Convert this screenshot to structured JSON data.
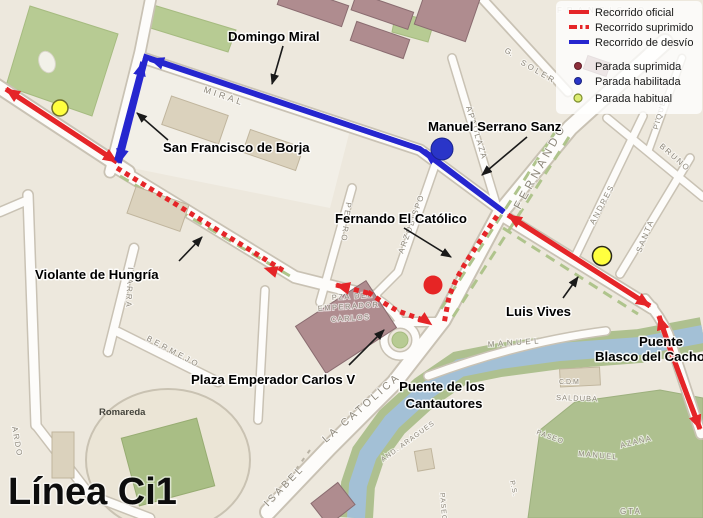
{
  "title": "Línea Ci1",
  "legend": {
    "recorrido_oficial": "Recorrido oficial",
    "recorrido_suprimido": "Recorrido suprimido",
    "recorrido_desvio": "Recorrido de desvío",
    "parada_suprimida": "Parada suprimida",
    "parada_habilitada": "Parada habilitada",
    "parada_habitual": "Parada habitual"
  },
  "callouts": {
    "domingo_miral": "Domingo Miral",
    "san_francisco_de_borja": "San Francisco de Borja",
    "manuel_serrano_sanz": "Manuel Serrano Sanz",
    "fernando_el_catolico": "Fernando El Católico",
    "violante_de_hungria": "Violante de Hungría",
    "luis_vives": "Luis Vives",
    "plaza_emperador_carlos": "Plaza Emperador Carlos V",
    "puente_cantautores_line1": "Puente de los",
    "puente_cantautores_line2": "Cantautores",
    "puente_cacho_line1": "Puente",
    "puente_cacho_line2": "Blasco del Cacho"
  },
  "streets": {
    "miral": "MIRAL",
    "g": "G.",
    "soler": "SOLER",
    "apaolaza": "APAOLAZA",
    "fernando": "FERNANDO",
    "pedro": "PEDRO",
    "arzobispo": "ARZOBISPO",
    "andres": "ANDRES",
    "santa": "SANTA",
    "bruno": "BRUNO",
    "piquer": "PIQUER",
    "ibarra": "IBARRA",
    "bermejo": "BERMEJO",
    "isabel": "ISABEL",
    "la_catolica": "LA CATOLICA",
    "manuel": "MANUEL",
    "and_aragues": "AND. ARAGUES",
    "paseo": "PASEO",
    "manuel_azana": "MANUEL",
    "azana": "AZAÑA",
    "cdm": "C.D.M",
    "salduba": "SALDUBA",
    "gta": "GTA",
    "ps": "P.S.",
    "paseo_sur": "PASEO",
    "ardo": "ARDO",
    "francisco": "FRANCISCO",
    "plaza_line1": "PZA DEL",
    "plaza_line2": "EMPERADOR",
    "plaza_line3": "CARLOS",
    "romareda": "Romareda"
  },
  "routes": {
    "oficial": {
      "style": "solid",
      "color": "#E52528"
    },
    "suprimido": {
      "style": "dashed",
      "color": "#E52528"
    },
    "desvio": {
      "style": "solid",
      "color": "#2626CF"
    }
  },
  "stops": [
    {
      "type": "Parada habitual",
      "color": "#FFFF3F"
    },
    {
      "type": "Parada habitual",
      "color": "#FFFF3F"
    },
    {
      "type": "Parada habilitada",
      "color": "#2A35C8"
    },
    {
      "type": "Parada suprimida",
      "color": "#E62525"
    }
  ],
  "colors": {
    "official_route": "#E52528",
    "detour_route": "#2626CF",
    "stop_habitual": "#FFFF3F",
    "stop_habilitada": "#2A35C8",
    "stop_suprimida": "#E62525",
    "legend_stop_suprimida": "#8E2F3B",
    "legend_stop_habilitada": "#2A35C8",
    "legend_stop_habitual": "#DCEC72",
    "map_background": "#EDE8DD",
    "park_green": "#B7CB93",
    "river_blue": "#A3C0D6",
    "building_maroon": "#AF8C8F"
  }
}
